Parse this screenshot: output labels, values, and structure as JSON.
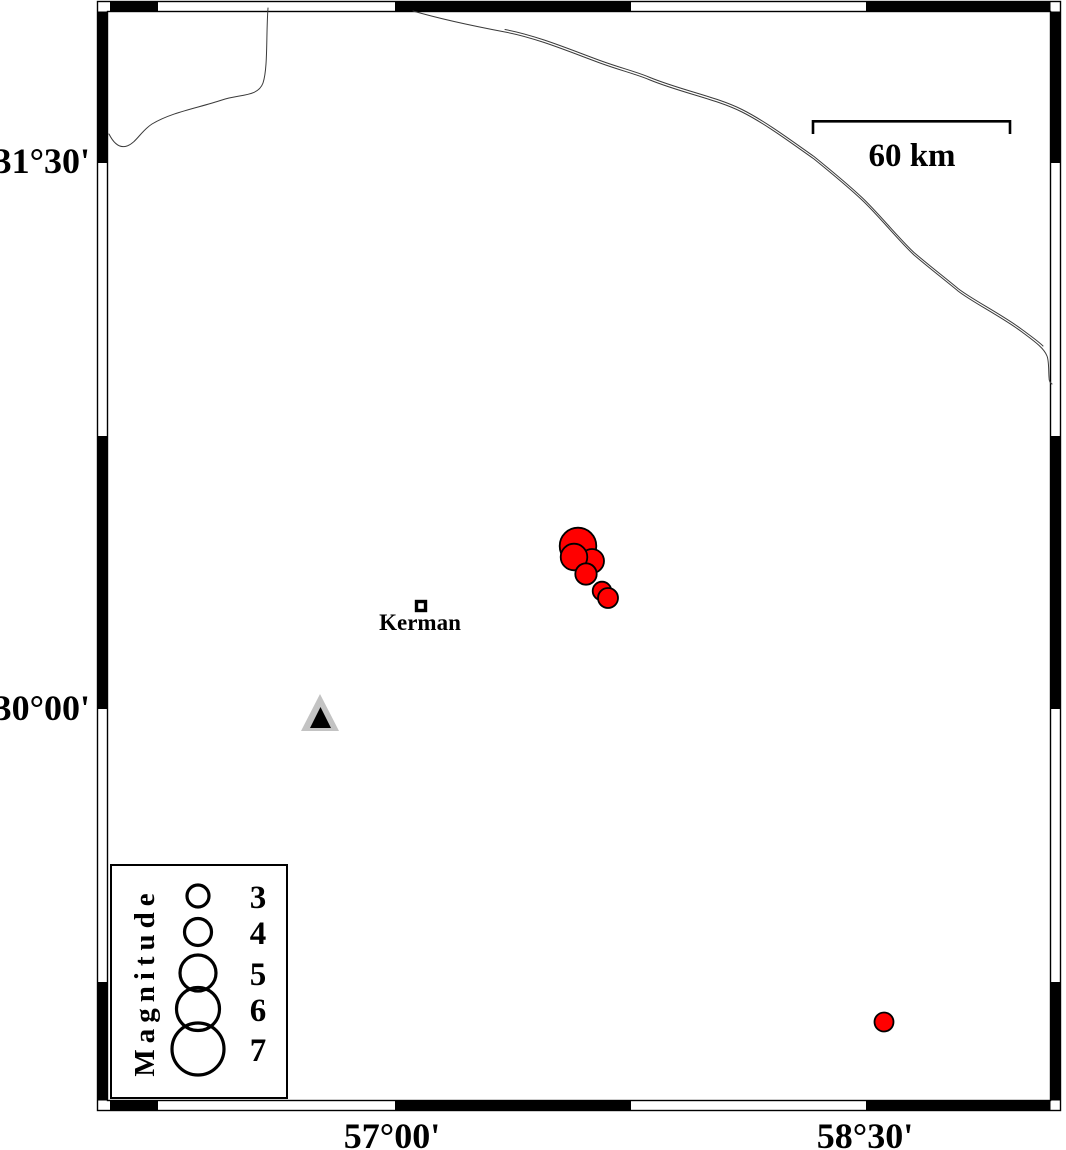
{
  "map": {
    "axis": {
      "left_labels": [
        {
          "text": "31°30'",
          "y": 173
        },
        {
          "text": "30°00'",
          "y": 720
        }
      ],
      "bottom_labels": [
        {
          "text": "57°00'",
          "x": 392
        },
        {
          "text": "58°30'",
          "x": 865
        }
      ]
    },
    "scale_bar": {
      "label": "60 km"
    },
    "city": {
      "name": "Kerman"
    },
    "station_triangle": {
      "outer_color": "#c3c3c3",
      "inner_color": "#000000"
    },
    "earthquakes": {
      "color": "#ff0000",
      "points": [
        {
          "x": 578,
          "y": 546,
          "r": 18.3
        },
        {
          "x": 592,
          "y": 561,
          "r": 12
        },
        {
          "x": 574,
          "y": 557,
          "r": 13.3
        },
        {
          "x": 586,
          "y": 574,
          "r": 10.7
        },
        {
          "x": 602,
          "y": 591,
          "r": 9.3
        },
        {
          "x": 608,
          "y": 598,
          "r": 10
        },
        {
          "x": 884,
          "y": 1022,
          "r": 9.5
        }
      ]
    },
    "legend": {
      "title": "Magnitude",
      "entries": [
        {
          "magnitude": "3",
          "r": 11,
          "y": 896
        },
        {
          "magnitude": "4",
          "r": 13.5,
          "y": 932
        },
        {
          "magnitude": "5",
          "r": 18,
          "y": 973
        },
        {
          "magnitude": "6",
          "r": 21.5,
          "y": 1009
        },
        {
          "magnitude": "7",
          "r": 26,
          "y": 1049
        }
      ]
    }
  }
}
